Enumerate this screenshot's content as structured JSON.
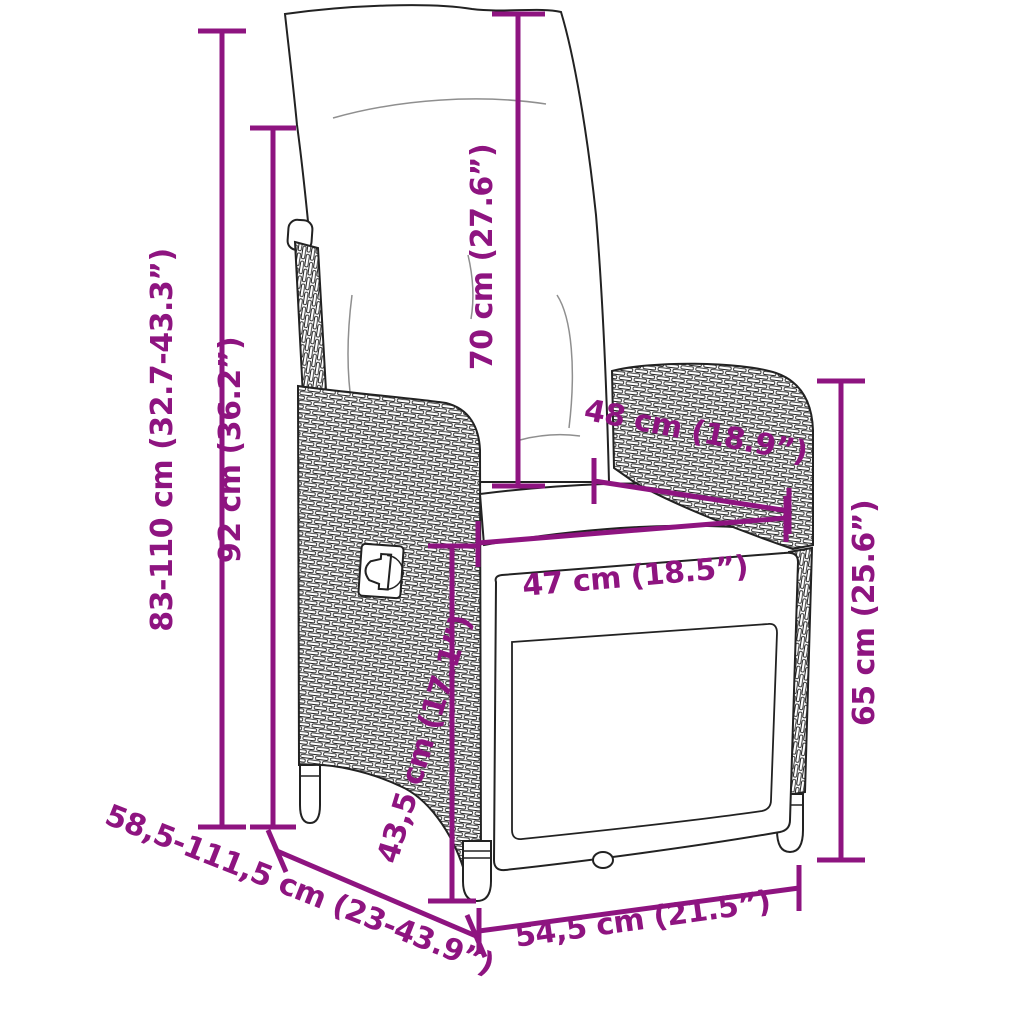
{
  "subject": "reclining-garden-chair-dimension-diagram",
  "colors": {
    "accent": "#8E1480",
    "outline": "#222222",
    "background": "#ffffff"
  },
  "labels": {
    "overall_height": "83-110 cm (32.7-43.3”)",
    "backrest_height": "92 cm (36.2”)",
    "back_cushion_height": "70 cm (27.6”)",
    "back_width": "48 cm (18.9”)",
    "seat_width": "47 cm (18.5”)",
    "armrest_height": "65 cm (25.6”)",
    "seat_height": "43,5 cm (17.1”)",
    "depth_range": "58,5-111,5 cm (23-43.9”)",
    "front_width": "54,5 cm (21.5”)"
  }
}
